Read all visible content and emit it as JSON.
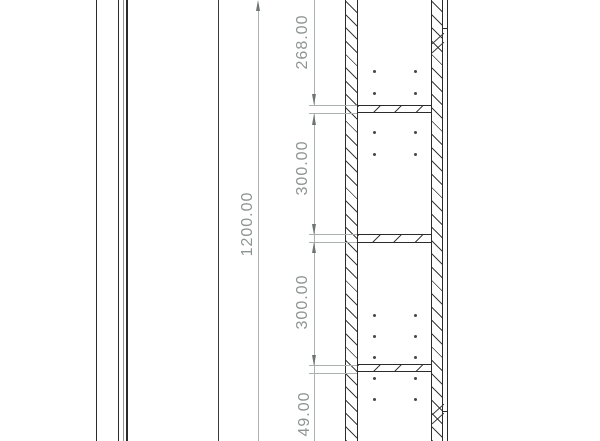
{
  "drawing": {
    "kind": "engineering-section-drawing",
    "dimensions": [
      {
        "label": "268.00"
      },
      {
        "label": "300.00"
      },
      {
        "label": "300.00"
      },
      {
        "label": "1200.00"
      },
      {
        "label": "49.00"
      }
    ],
    "colors": {
      "background": "#ffffff",
      "edge": "#2b2b2b",
      "hatch": "#3c3c3c",
      "dimension_line": "#abb1b0",
      "dimension_text": "#8e9494",
      "arrow": "#6e7473"
    }
  }
}
